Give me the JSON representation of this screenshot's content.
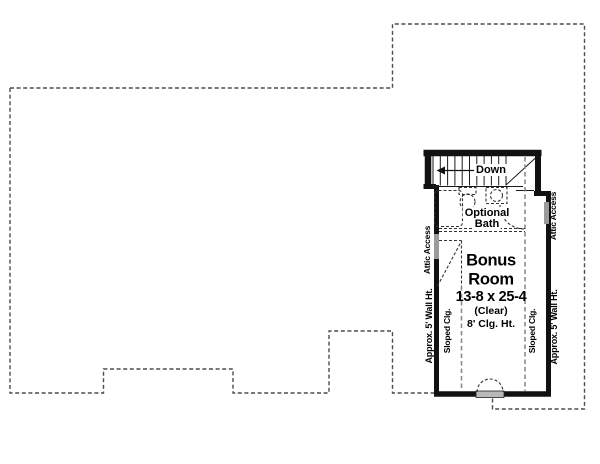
{
  "plan": {
    "room": {
      "title_line1": "Bonus",
      "title_line2": "Room",
      "dimensions": "13-8 x 25-4",
      "clear_note": "(Clear)",
      "ceiling_height": "8' Clg. Ht."
    },
    "stairs": {
      "down_label": "Down",
      "direction_icon": "left-arrow-icon"
    },
    "bath": {
      "label_line1": "Optional",
      "label_line2": "Bath"
    },
    "side_labels": {
      "attic_access_left": "Attic Access",
      "attic_access_right": "Attic Access",
      "wall_height_left": "Approx. 5' Wall Ht.",
      "wall_height_right": "Approx. 5' Wall Ht.",
      "sloped_ceiling_left": "Sloped Clg.",
      "sloped_ceiling_right": "Sloped Clg."
    },
    "colors": {
      "wall": "#111111",
      "roof_dash": "#4d4d4d",
      "sloped_dash": "#8a8a8a",
      "fixture_dash": "#333333",
      "panel_gray": "#9b9b9b",
      "background": "#ffffff"
    }
  }
}
